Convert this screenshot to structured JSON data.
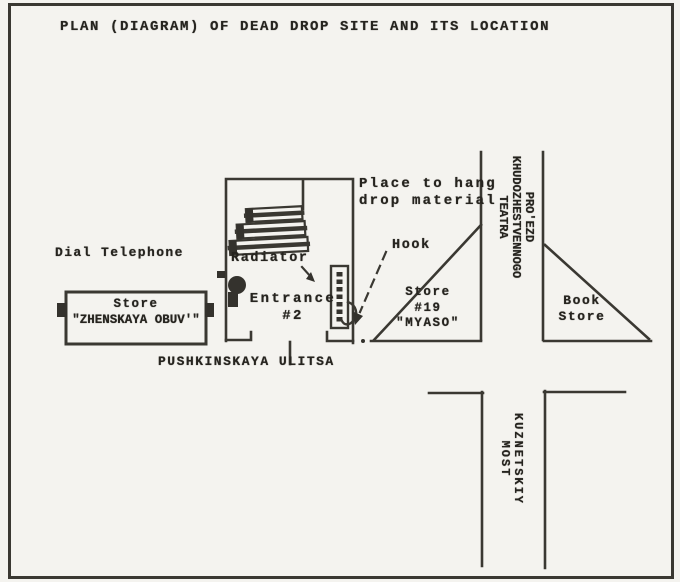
{
  "title": "PLAN (DIAGRAM) OF DEAD DROP SITE AND ITS LOCATION",
  "map": {
    "dial_telephone": "Dial Telephone",
    "store_obuv": {
      "line1": "Store",
      "line2": "\"ZHENSKAYA OBUV'\""
    },
    "radiator": "Radiator",
    "entrance": {
      "line1": "Entrance",
      "line2": "#2"
    },
    "street_pushkinskaya": "PUSHKINSKAYA ULITSA",
    "place_to_hang": {
      "line1": "Place to hang",
      "line2": "drop material"
    },
    "hook": "Hook",
    "store_myaso": {
      "line1": "Store",
      "line2": "#19",
      "line3": "\"MYASO\""
    },
    "street_proezd": {
      "line1": "PRO'EZD",
      "line2": "KHUDOZHESTVENNOGO",
      "line3": "TEATRA"
    },
    "book_store": {
      "line1": "Book",
      "line2": "Store"
    },
    "street_kuznetskiy": {
      "line1": "KUZNETSKIY",
      "line2": "MOST"
    }
  },
  "colors": {
    "ink": "#33312d",
    "text": "#26241f",
    "paper": "#f4f3ef"
  }
}
